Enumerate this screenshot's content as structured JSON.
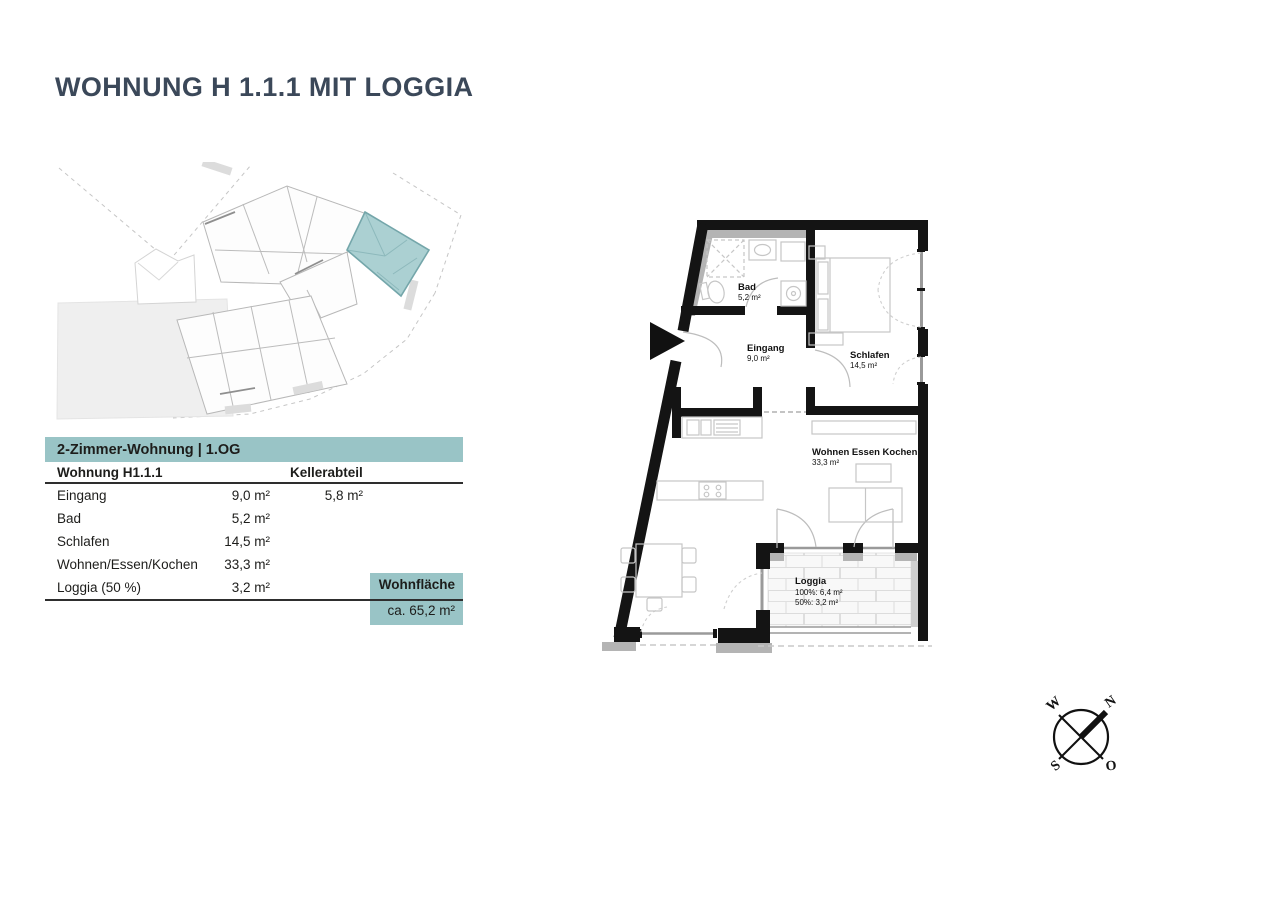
{
  "page": {
    "title": "WOHNUNG H 1.1.1 MIT LOGGIA"
  },
  "colors": {
    "accent_teal": "#99c4c6",
    "highlight_unit_teal": "#abd0d2",
    "title_color": "#3b4859",
    "wall_black": "#141414",
    "wall_gray": "#b4b4b4"
  },
  "table": {
    "header": "2-Zimmer-Wohnung | 1.OG",
    "col1_header": "Wohnung H1.1.1",
    "col2_header": "Kellerabteil",
    "rows": [
      {
        "label": "Eingang",
        "area": "9,0 m²",
        "keller": "5,8 m²"
      },
      {
        "label": "Bad",
        "area": "5,2 m²",
        "keller": ""
      },
      {
        "label": "Schlafen",
        "area": "14,5 m²",
        "keller": ""
      },
      {
        "label": "Wohnen/Essen/Kochen",
        "area": "33,3 m²",
        "keller": ""
      },
      {
        "label": "Loggia (50 %)",
        "area": "3,2 m²",
        "keller": ""
      }
    ],
    "total_label": "Wohnfläche",
    "total_value": "ca. 65,2 m²"
  },
  "floor_plan": {
    "rooms": [
      {
        "name": "Bad",
        "area": "5,2 m²"
      },
      {
        "name": "Eingang",
        "area": "9,0 m²"
      },
      {
        "name": "Schlafen",
        "area": "14,5 m²"
      },
      {
        "name": "Wohnen Essen Kochen",
        "area": "33,3 m²"
      },
      {
        "name": "Loggia",
        "area_100": "100%: 6,4 m²",
        "area_50": "50%: 3,2 m²"
      }
    ]
  },
  "compass": {
    "n": "N",
    "o": "O",
    "s": "S",
    "w": "W"
  }
}
